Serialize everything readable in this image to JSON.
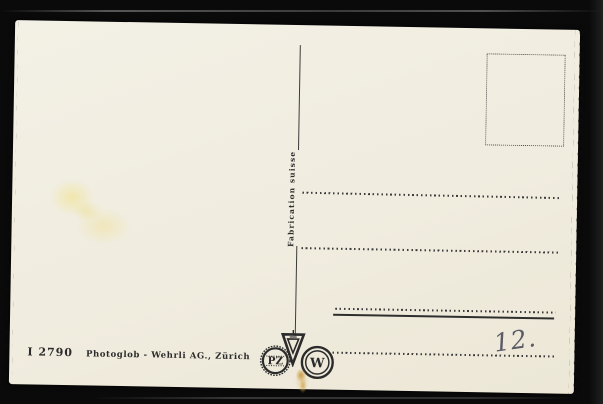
{
  "postcard": {
    "type_note": "back side of vintage postcard, blank address side",
    "divider_label": "Fabrication suisse",
    "imprint": {
      "number": "I 2790",
      "publisher": "Photoglob - Wehrli AG., Zürich"
    },
    "handwritten_number": "12.",
    "logos": {
      "pz_text": "PZ",
      "w_text": "W",
      "v_mark": "inverted-triangle trademark"
    },
    "address_lines_count": 4,
    "colors": {
      "background": "#0a0a0a",
      "card": "#f0ecdf",
      "ink": "#2e2e2e",
      "pencil": "#5b5b66",
      "stain_light": "#f0e182",
      "stain_dark": "#c6943a"
    }
  }
}
